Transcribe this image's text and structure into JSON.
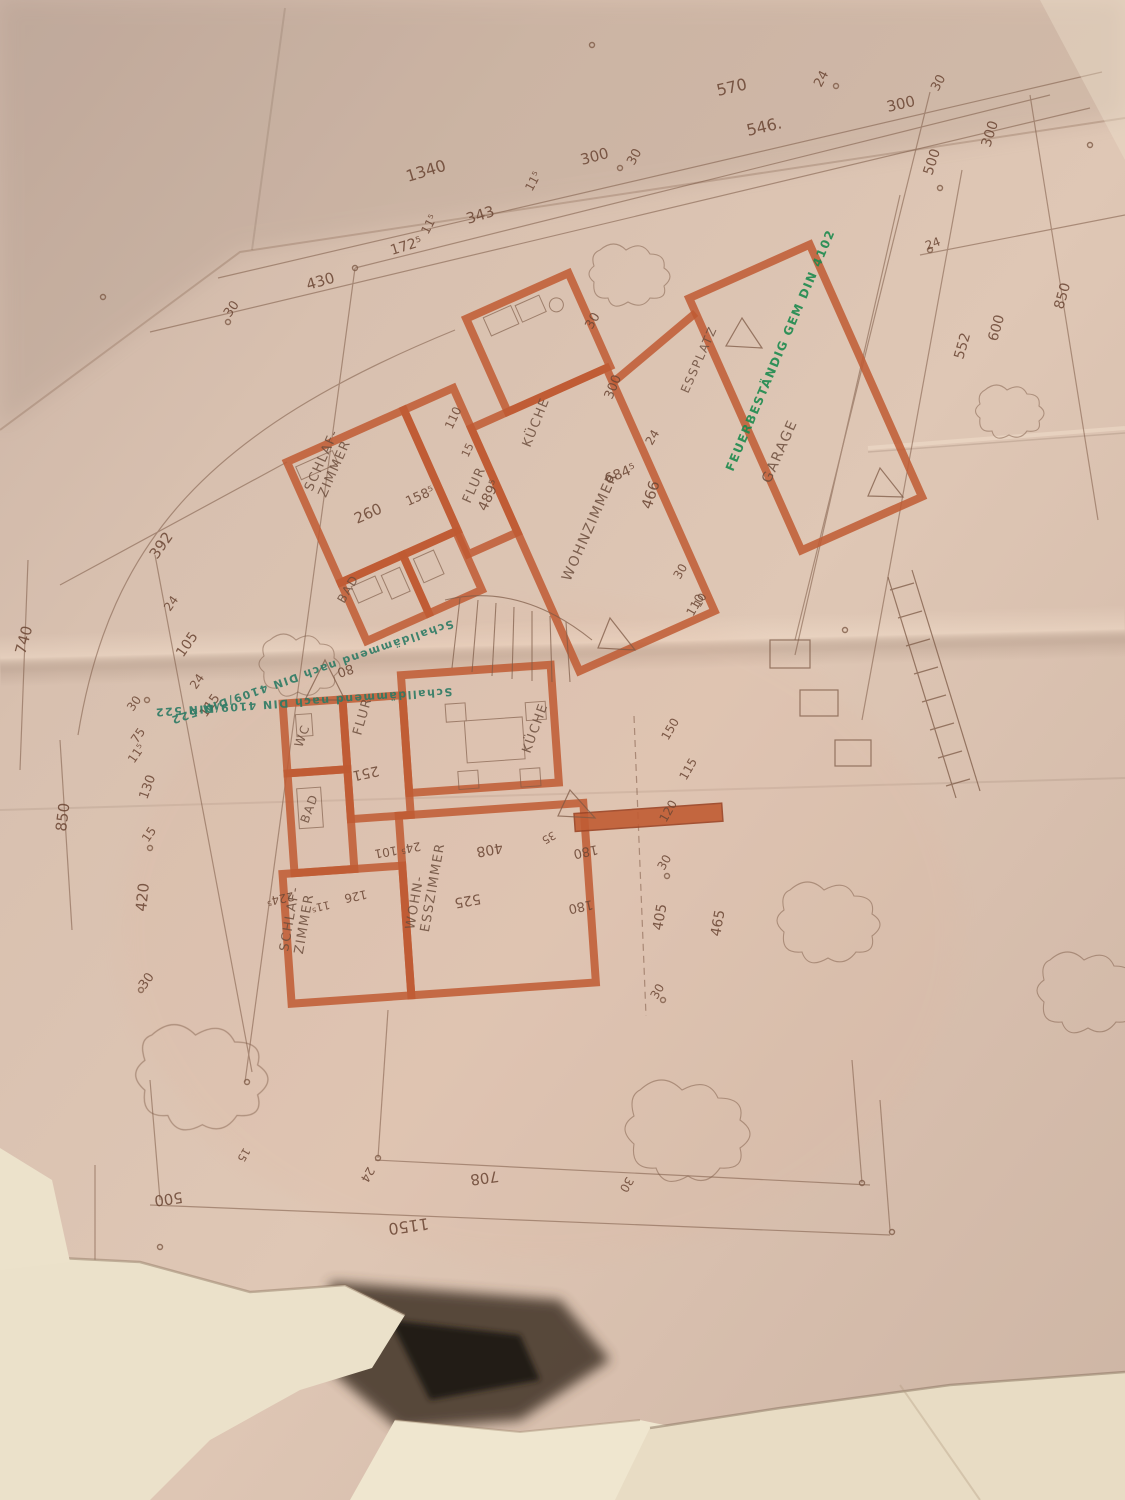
{
  "style": {
    "paper_base": "#d9c1b0",
    "paper_dark_top": "#c7b1a3",
    "paper_light_band": "#e9d3c1",
    "wall_color": "#bf5b33",
    "pencil_color": "#7d5a46",
    "dim_text_color": "#6d4836",
    "stamp_green": "#1c8a4e",
    "stamp_teal": "#2c7a64",
    "torn_paper": "#ebe1ca",
    "shadow_gap": "#2c241c"
  },
  "rooms": [
    {
      "t": [
        "SCHLAF-",
        "ZIMMER"
      ],
      "x": 312,
      "y": 492,
      "r": -66,
      "s": 13,
      "lh": 15,
      "n": "room-label-schlafzimmer-upper"
    },
    {
      "t": [
        "BAD"
      ],
      "x": 344,
      "y": 604,
      "r": -60,
      "s": 12,
      "n": "room-label-bad-upper"
    },
    {
      "t": [
        "FLUR"
      ],
      "x": 470,
      "y": 504,
      "r": -66,
      "s": 13,
      "n": "room-label-flur-upper"
    },
    {
      "t": [
        "KÜCHE"
      ],
      "x": 530,
      "y": 448,
      "r": -68,
      "s": 13,
      "n": "room-label-kueche-upper"
    },
    {
      "t": [
        "WOHNZIMMER"
      ],
      "x": 570,
      "y": 582,
      "r": -66,
      "s": 14,
      "n": "room-label-wohnzimmer"
    },
    {
      "t": [
        "ESSPLATZ"
      ],
      "x": 688,
      "y": 394,
      "r": -66,
      "s": 12,
      "n": "room-label-essplatz"
    },
    {
      "t": [
        "GARAGE"
      ],
      "x": 770,
      "y": 484,
      "r": -66,
      "s": 14,
      "n": "room-label-garage"
    },
    {
      "t": [
        "WC"
      ],
      "x": 302,
      "y": 748,
      "r": -70,
      "s": 12,
      "n": "room-label-wc"
    },
    {
      "t": [
        "FLUR"
      ],
      "x": 361,
      "y": 736,
      "r": -74,
      "s": 13,
      "n": "room-label-flur-lower"
    },
    {
      "t": [
        "BAD"
      ],
      "x": 308,
      "y": 824,
      "r": -70,
      "s": 12,
      "n": "room-label-bad-lower"
    },
    {
      "t": [
        "SCHLAF-",
        "ZIMMER"
      ],
      "x": 288,
      "y": 952,
      "r": -80,
      "s": 13,
      "lh": 15,
      "n": "room-label-schlafzimmer-lower"
    },
    {
      "t": [
        "WOHN-",
        "ESSZIMMER"
      ],
      "x": 414,
      "y": 930,
      "r": -80,
      "s": 13,
      "lh": 15,
      "n": "room-label-wohn-esszimmer"
    },
    {
      "t": [
        "KÜCHE"
      ],
      "x": 530,
      "y": 754,
      "r": -70,
      "s": 13,
      "n": "room-label-kueche-lower"
    }
  ],
  "stamps": [
    {
      "t": "FEUERBESTÄNDIG GEM DIN 4102",
      "x": 733,
      "y": 472,
      "r": -67,
      "s": 12,
      "c": "#1c8a4e",
      "n": "stamp-feuerbestaendig"
    },
    {
      "t": "Schalldämmend nach DIN 4109/DIN 522",
      "x": 452,
      "y": 620,
      "r": 161,
      "s": 11,
      "c": "#2c7a64",
      "n": "stamp-schalldaemmend-1"
    },
    {
      "t": "Schalldämmend nach DIN 4109/DIN 522",
      "x": 452,
      "y": 688,
      "r": 176,
      "s": 11,
      "c": "#2c7a64",
      "n": "stamp-schalldaemmend-2"
    }
  ],
  "dims": [
    {
      "t": "1340",
      "x": 408,
      "y": 182,
      "r": -17,
      "s": 16
    },
    {
      "t": "570",
      "x": 718,
      "y": 96,
      "r": -13,
      "s": 16
    },
    {
      "t": "24",
      "x": 821,
      "y": 88,
      "r": -62,
      "s": 13
    },
    {
      "t": "546.",
      "x": 748,
      "y": 136,
      "r": -13,
      "s": 16
    },
    {
      "t": "30",
      "x": 634,
      "y": 166,
      "r": -62,
      "s": 13
    },
    {
      "t": "300",
      "x": 888,
      "y": 112,
      "r": -13,
      "s": 15
    },
    {
      "t": "30",
      "x": 938,
      "y": 92,
      "r": -62,
      "s": 13
    },
    {
      "t": "300",
      "x": 582,
      "y": 165,
      "r": -15,
      "s": 15
    },
    {
      "t": "343",
      "x": 468,
      "y": 224,
      "r": -17,
      "s": 15
    },
    {
      "t": "172⁵",
      "x": 392,
      "y": 255,
      "r": -17,
      "s": 14
    },
    {
      "t": "11⁵",
      "x": 428,
      "y": 235,
      "r": -62,
      "s": 12
    },
    {
      "t": "11⁵",
      "x": 532,
      "y": 192,
      "r": -62,
      "s": 12
    },
    {
      "t": "430",
      "x": 308,
      "y": 290,
      "r": -16,
      "s": 15
    },
    {
      "t": "30",
      "x": 230,
      "y": 318,
      "r": -55,
      "s": 13
    },
    {
      "t": "500",
      "x": 932,
      "y": 176,
      "r": -72,
      "s": 14
    },
    {
      "t": "300",
      "x": 990,
      "y": 148,
      "r": -72,
      "s": 14
    },
    {
      "t": "24",
      "x": 927,
      "y": 250,
      "r": -20,
      "s": 12
    },
    {
      "t": "850",
      "x": 1063,
      "y": 310,
      "r": -74,
      "s": 14
    },
    {
      "t": "600",
      "x": 997,
      "y": 342,
      "r": -74,
      "s": 14
    },
    {
      "t": "552",
      "x": 963,
      "y": 360,
      "r": -74,
      "s": 14
    },
    {
      "t": "30",
      "x": 592,
      "y": 330,
      "r": -60,
      "s": 13
    },
    {
      "t": "392",
      "x": 157,
      "y": 560,
      "r": -55,
      "s": 15
    },
    {
      "t": "24",
      "x": 170,
      "y": 612,
      "r": -55,
      "s": 12
    },
    {
      "t": "105",
      "x": 183,
      "y": 658,
      "r": -55,
      "s": 14
    },
    {
      "t": "24",
      "x": 196,
      "y": 690,
      "r": -55,
      "s": 12
    },
    {
      "t": "115",
      "x": 206,
      "y": 718,
      "r": -55,
      "s": 13
    },
    {
      "t": "740",
      "x": 25,
      "y": 655,
      "r": -75,
      "s": 15
    },
    {
      "t": "850",
      "x": 66,
      "y": 832,
      "r": -83,
      "s": 15
    },
    {
      "t": "30",
      "x": 133,
      "y": 712,
      "r": -55,
      "s": 12
    },
    {
      "t": "75",
      "x": 137,
      "y": 744,
      "r": -55,
      "s": 12
    },
    {
      "t": "11⁵",
      "x": 134,
      "y": 764,
      "r": -55,
      "s": 12
    },
    {
      "t": "130",
      "x": 147,
      "y": 800,
      "r": -70,
      "s": 13
    },
    {
      "t": "15",
      "x": 148,
      "y": 843,
      "r": -55,
      "s": 12
    },
    {
      "t": "420",
      "x": 146,
      "y": 912,
      "r": -84,
      "s": 15
    },
    {
      "t": "30",
      "x": 145,
      "y": 990,
      "r": -55,
      "s": 13
    },
    {
      "t": "260",
      "x": 357,
      "y": 524,
      "r": -24,
      "s": 15
    },
    {
      "t": "158⁵",
      "x": 408,
      "y": 506,
      "r": -24,
      "s": 13
    },
    {
      "t": "110",
      "x": 452,
      "y": 430,
      "r": -65,
      "s": 12
    },
    {
      "t": "15",
      "x": 468,
      "y": 458,
      "r": -65,
      "s": 11
    },
    {
      "t": "489⁵",
      "x": 486,
      "y": 512,
      "r": -65,
      "s": 14
    },
    {
      "t": "300",
      "x": 612,
      "y": 400,
      "r": -68,
      "s": 13
    },
    {
      "t": "684⁵",
      "x": 607,
      "y": 484,
      "r": -22,
      "s": 14
    },
    {
      "t": "24",
      "x": 652,
      "y": 446,
      "r": -60,
      "s": 12
    },
    {
      "t": "466",
      "x": 651,
      "y": 510,
      "r": -72,
      "s": 15
    },
    {
      "t": "30",
      "x": 680,
      "y": 580,
      "r": -60,
      "s": 12
    },
    {
      "t": "110",
      "x": 693,
      "y": 617,
      "r": -60,
      "s": 12
    },
    {
      "t": "80",
      "x": 352,
      "y": 664,
      "r": 162,
      "s": 13
    },
    {
      "t": "251",
      "x": 378,
      "y": 766,
      "r": 168,
      "s": 14
    },
    {
      "t": "24⁵ 101",
      "x": 420,
      "y": 842,
      "r": 170,
      "s": 12
    },
    {
      "t": "224⁵",
      "x": 293,
      "y": 892,
      "r": 168,
      "s": 12
    },
    {
      "t": "11⁵",
      "x": 329,
      "y": 901,
      "r": 168,
      "s": 11
    },
    {
      "t": "126",
      "x": 366,
      "y": 890,
      "r": 168,
      "s": 12
    },
    {
      "t": "525",
      "x": 480,
      "y": 894,
      "r": 170,
      "s": 14
    },
    {
      "t": "408",
      "x": 502,
      "y": 843,
      "r": 170,
      "s": 14
    },
    {
      "t": "35",
      "x": 553,
      "y": 831,
      "r": 150,
      "s": 11
    },
    {
      "t": "180",
      "x": 597,
      "y": 845,
      "r": 168,
      "s": 13
    },
    {
      "t": "180",
      "x": 592,
      "y": 900,
      "r": 168,
      "s": 13
    },
    {
      "t": "30",
      "x": 664,
      "y": 871,
      "r": -60,
      "s": 12
    },
    {
      "t": "120",
      "x": 666,
      "y": 823,
      "r": -60,
      "s": 12
    },
    {
      "t": "115",
      "x": 686,
      "y": 781,
      "r": -60,
      "s": 12
    },
    {
      "t": "150",
      "x": 668,
      "y": 741,
      "r": -60,
      "s": 12
    },
    {
      "t": "405",
      "x": 662,
      "y": 931,
      "r": -80,
      "s": 14
    },
    {
      "t": "465",
      "x": 720,
      "y": 937,
      "r": -80,
      "s": 14
    },
    {
      "t": "30",
      "x": 657,
      "y": 1000,
      "r": -60,
      "s": 12
    },
    {
      "t": "10",
      "x": 700,
      "y": 608,
      "r": -60,
      "s": 11
    },
    {
      "t": "1150",
      "x": 428,
      "y": 1218,
      "r": 172,
      "s": 16
    },
    {
      "t": "708",
      "x": 498,
      "y": 1171,
      "r": 172,
      "s": 15
    },
    {
      "t": "24",
      "x": 368,
      "y": 1166,
      "r": 120,
      "s": 12
    },
    {
      "t": "30",
      "x": 627,
      "y": 1176,
      "r": 120,
      "s": 12
    },
    {
      "t": "500",
      "x": 182,
      "y": 1192,
      "r": 172,
      "s": 15
    },
    {
      "t": "15",
      "x": 244,
      "y": 1147,
      "r": 120,
      "s": 11
    }
  ]
}
